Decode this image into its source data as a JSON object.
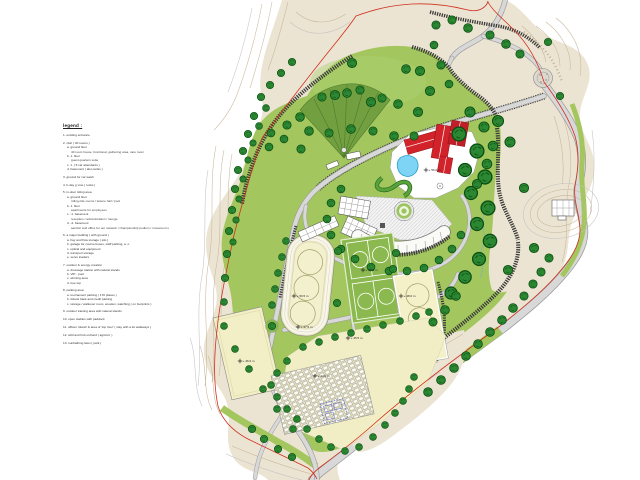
{
  "legend": {
    "title": "legend :",
    "items": [
      {
        "text": "1. existing entrance",
        "indent": 0
      },
      {
        "text": "2. club ( 40 rooms )",
        "indent": 0
      },
      {
        "text": "a. ground floor",
        "indent": 1
      },
      {
        "text": "40 room house, functional, gathering area, care room",
        "indent": 2
      },
      {
        "text": "b. 1. floor",
        "indent": 1
      },
      {
        "text": "guest quarters suite",
        "indent": 2
      },
      {
        "text": "c. 1. ( 6 car attendants )",
        "indent": 1
      },
      {
        "text": "d. basement ( also tanks )",
        "indent": 1
      },
      {
        "text": "3. ground for car wash",
        "indent": 0
      },
      {
        "text": "4. b-day g vine ( rocks )",
        "indent": 0
      },
      {
        "text": "5. in-door riding area",
        "indent": 0
      },
      {
        "text": "a. ground floor",
        "indent": 1
      },
      {
        "text": "riding-ride rooms / leisure hall / pool",
        "indent": 2
      },
      {
        "text": "b. 1. floor",
        "indent": 1
      },
      {
        "text": "apartments for employees",
        "indent": 2
      },
      {
        "text": "c. -1. basement",
        "indent": 1
      },
      {
        "text": "reception / administration / lounge",
        "indent": 2
      },
      {
        "text": "d. -2. basement",
        "indent": 1
      },
      {
        "text": "aerobic and office for our network / championship podium / movement s",
        "indent": 2
      },
      {
        "text": "6. a major building ( with ground )",
        "indent": 0
      },
      {
        "text": "a. hay and flow storage ( silo )",
        "indent": 1
      },
      {
        "text": "b. garage for course buses, staff parking, a. o.",
        "indent": 1
      },
      {
        "text": "c. optical and equipment",
        "indent": 1
      },
      {
        "text": "d. transport storage",
        "indent": 1
      },
      {
        "text": "e. servo loaders",
        "indent": 1
      },
      {
        "text": "7. outdoor & energy creation",
        "indent": 0
      },
      {
        "text": "a. dressage station with natural stands",
        "indent": 1
      },
      {
        "text": "b. VIP - pool",
        "indent": 1
      },
      {
        "text": "c. winning area",
        "indent": 1
      },
      {
        "text": "d. tree top",
        "indent": 1
      },
      {
        "text": "8. parking area",
        "indent": 0
      },
      {
        "text": "a. tournament parking ( 170 places )",
        "indent": 1
      },
      {
        "text": "b. tickets back and credit parking",
        "indent": 1
      },
      {
        "text": "c. storage / walkover room, wooden, watching ( on footprints )",
        "indent": 1
      },
      {
        "text": "9. outdoor training area with natural stands",
        "indent": 0
      },
      {
        "text": "10. open stables with paddock",
        "indent": 0
      },
      {
        "text": "11. offices 'island' & area of 'top river' ( stay with a lot walkways )",
        "indent": 0
      },
      {
        "text": "12. wild and fruit orchard ( agricult. )",
        "indent": 0
      },
      {
        "text": "13. sunbathing lawn ( park )",
        "indent": 0
      }
    ]
  },
  "markers": [
    {
      "x": 426,
      "y": 170,
      "label": "+ 56.0 m"
    },
    {
      "x": 363,
      "y": 270,
      "label": "+ 52.5 m"
    },
    {
      "x": 294,
      "y": 296,
      "label": "+ 50.5 m"
    },
    {
      "x": 401,
      "y": 296,
      "label": "+ 48.0 m"
    },
    {
      "x": 298,
      "y": 327,
      "label": "+ 47.5 m"
    },
    {
      "x": 348,
      "y": 338,
      "label": "+ 45.5 m"
    },
    {
      "x": 240,
      "y": 361,
      "label": "+ 46.0 m"
    },
    {
      "x": 315,
      "y": 376,
      "label": "+ 44.0 m"
    }
  ],
  "colors": {
    "paper": "#ffffff",
    "terrain_beige": "#ece4d2",
    "contour_line": "#c7b69a",
    "green_main": "#a3c75e",
    "green_dark": "#72a040",
    "green_courts": "#8cb94f",
    "tree_green": "#2b8731",
    "road_gray": "#d8d8d8",
    "road_casing": "#9a9a9a",
    "hatch_dark": "#3a3a3a",
    "roof_red": "#d2232b",
    "pool_blue": "#7ed4f4",
    "court_cream": "#f3f0c9",
    "boundary_red": "#d03020",
    "annotation_blue": "#5a67c8"
  }
}
